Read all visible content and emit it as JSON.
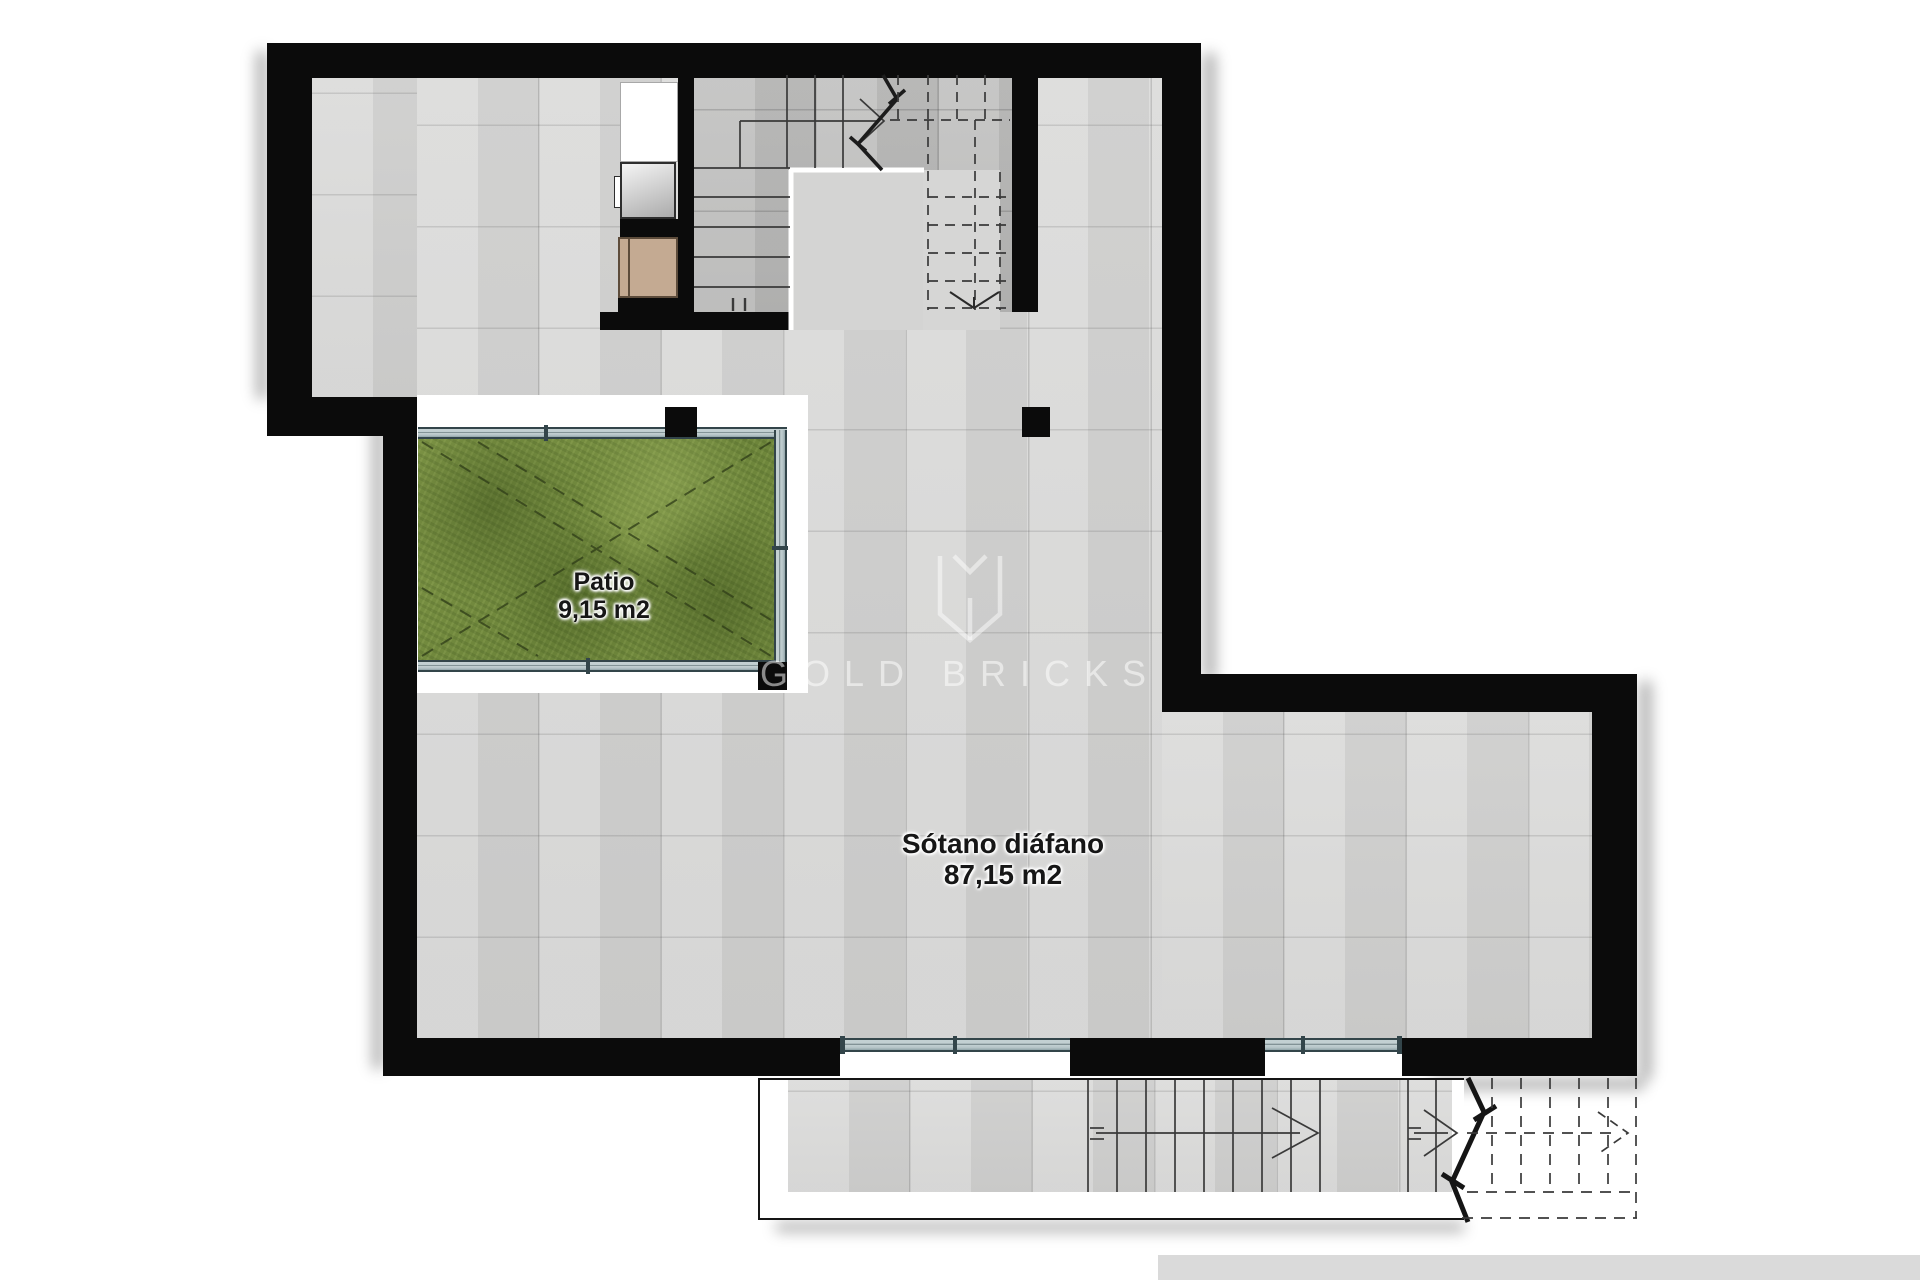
{
  "plan": {
    "title": "Basement floor plan",
    "rooms": [
      {
        "name": "Patio",
        "area": "9,15 m2"
      },
      {
        "name": "Sótano diáfano",
        "area": "87,15 m2"
      }
    ],
    "watermark": {
      "brand": "GOLD BRICKS",
      "logo": "gold-bricks-monogram"
    },
    "features": [
      "u-shaped-interior-stair-with-dashed-upper-flight",
      "elevator-shaft-and-storage-box",
      "grass-patio-with-glazing",
      "exterior-terrace-stair-with-break-line-and-dashed-continuation",
      "two-glazed-window-bands-in-bottom-wall"
    ],
    "colors": {
      "wall": "#0b0b0b",
      "floor_tile": "#d6d6d5",
      "stair_floor": "#bdbdbc",
      "grass": "#758d40",
      "glazing": "#c3d0d2",
      "glazing_frame": "#33454a",
      "wood_box": "#c4aa92",
      "door_panel_light": "#f2f2f2",
      "door_panel_dark": "#b5b5b5",
      "bottom_bar": "#dadada",
      "label_text": "#161616",
      "watermark_text": "rgba(255,255,255,0.52)"
    }
  }
}
